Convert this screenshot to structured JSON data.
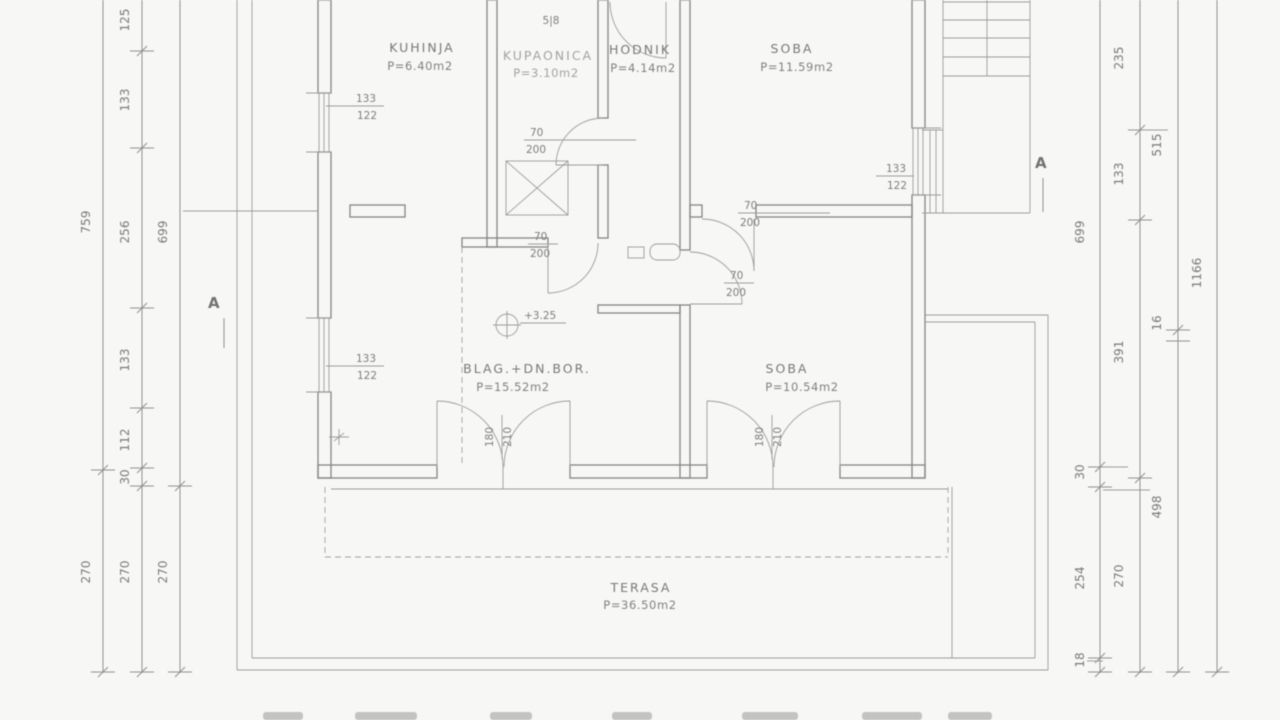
{
  "drawing_type": "floor-plan",
  "rooms": {
    "kuhinja": {
      "name": "KUHINJA",
      "area": "P=6.40m2"
    },
    "kupaonica": {
      "name": "KUPAONICA",
      "area": "P=3.10m2"
    },
    "hodnik": {
      "name": "HODNIK",
      "area": "P=4.14m2"
    },
    "soba_top": {
      "name": "SOBA",
      "area": "P=11.59m2"
    },
    "blag": {
      "name": "BLAG.+DN.BOR.",
      "area": "P=15.52m2"
    },
    "soba_bottom": {
      "name": "SOBA",
      "area": "P=10.54m2"
    },
    "terasa": {
      "name": "TERASA",
      "area": "P=36.50m2"
    }
  },
  "labels": {
    "door": {
      "top": "70",
      "bottom": "200"
    },
    "window": {
      "top": "133",
      "bottom": "122"
    },
    "balcony": {
      "w": "180",
      "h": "210"
    },
    "level": "+3.25",
    "stair": "5|8",
    "section": "A"
  },
  "dims": {
    "l1": [
      "759",
      "270"
    ],
    "l2": [
      "125",
      "133",
      "256",
      "133",
      "112",
      "30",
      "270"
    ],
    "l3": [
      "699",
      "270"
    ],
    "r1": [
      "699",
      "30",
      "254",
      "18"
    ],
    "r2": [
      "235",
      "133",
      "391",
      "270"
    ],
    "r3": [
      "515",
      "16",
      "498"
    ],
    "r4": [
      "1166"
    ]
  },
  "line_color": "#828282",
  "text_color": "#787878",
  "background_color": "#f7f7f5"
}
